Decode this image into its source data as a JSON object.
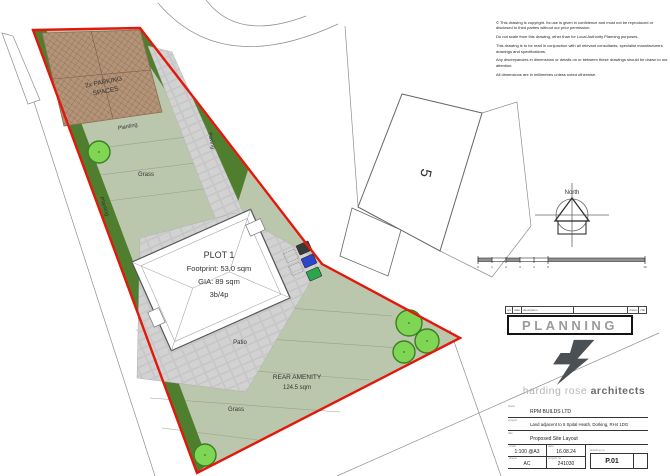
{
  "colors": {
    "boundary_red": "#e3170b",
    "planting_green": "#4e7e2e",
    "grass_green": "#bac7ac",
    "paving_grey": "#d2d2d2",
    "parking_brown": "#b49478",
    "tree_green": "#7fd554",
    "bin_grey": "#3a3a3a",
    "bin_blue": "#2b46c8",
    "bin_green": "#2da44e"
  },
  "notes": {
    "p1": "© This drawing is copyright. Its use is given in confidence and must not be reproduced or disclosed to third parties without our prior permission.",
    "p2": "Do not scale from this drawing, other than for Local Authority Planning purposes.",
    "p3": "This drawing is to be read in conjunction with all relevant consultants, specialist manufacturers drawings and specifications.",
    "p4": "Any discrepancies in dimensions or details on or between these drawings should be drawn to our attention.",
    "p5": "All dimensions are in millimetres unless noted otherwise."
  },
  "plan": {
    "parking_line1": "2x PARKING",
    "parking_line2": "SPACES",
    "planting_mid": "Planting",
    "planting_left": "Planting",
    "paving": "Paving",
    "grass_upper": "Grass",
    "plot1_name": "PLOT 1",
    "plot1_footprint": "Footprint: 53.0 sqm",
    "plot1_gia": "GIA: 89 sqm",
    "plot1_bed": "3b/4p",
    "patio": "Patio",
    "rear_amenity": "REAR AMENITY",
    "rear_amenity_area": "124.5 sqm",
    "grass_lower": "Grass",
    "house5": "5",
    "north": "North",
    "scale_ticks": [
      "0",
      "1",
      "2",
      "3",
      "4",
      "5",
      "10"
    ]
  },
  "title_block": {
    "rev_headers": [
      "rev",
      "date",
      "description",
      "drawn",
      "chk"
    ],
    "status": "PLANNING",
    "firm_light": "harding rose ",
    "firm_bold": "architects",
    "client_label": "client",
    "client": "RPM BUILDS LTD",
    "project_label": "project",
    "project": "Land adjacent to 5 Spital Heath, Dorking, RH4 1DG",
    "title_label": "title",
    "title": "Proposed Site Layout",
    "scale_label": "scale",
    "scale": "1:100 @A3",
    "date_label": "date",
    "date": "16.08.24",
    "drawn_label": "drawn",
    "drawn": "AC",
    "project_no_label": "project no",
    "project_no": "241030",
    "drawing_no_label": "drawing no",
    "drawing_no": "P.01"
  }
}
